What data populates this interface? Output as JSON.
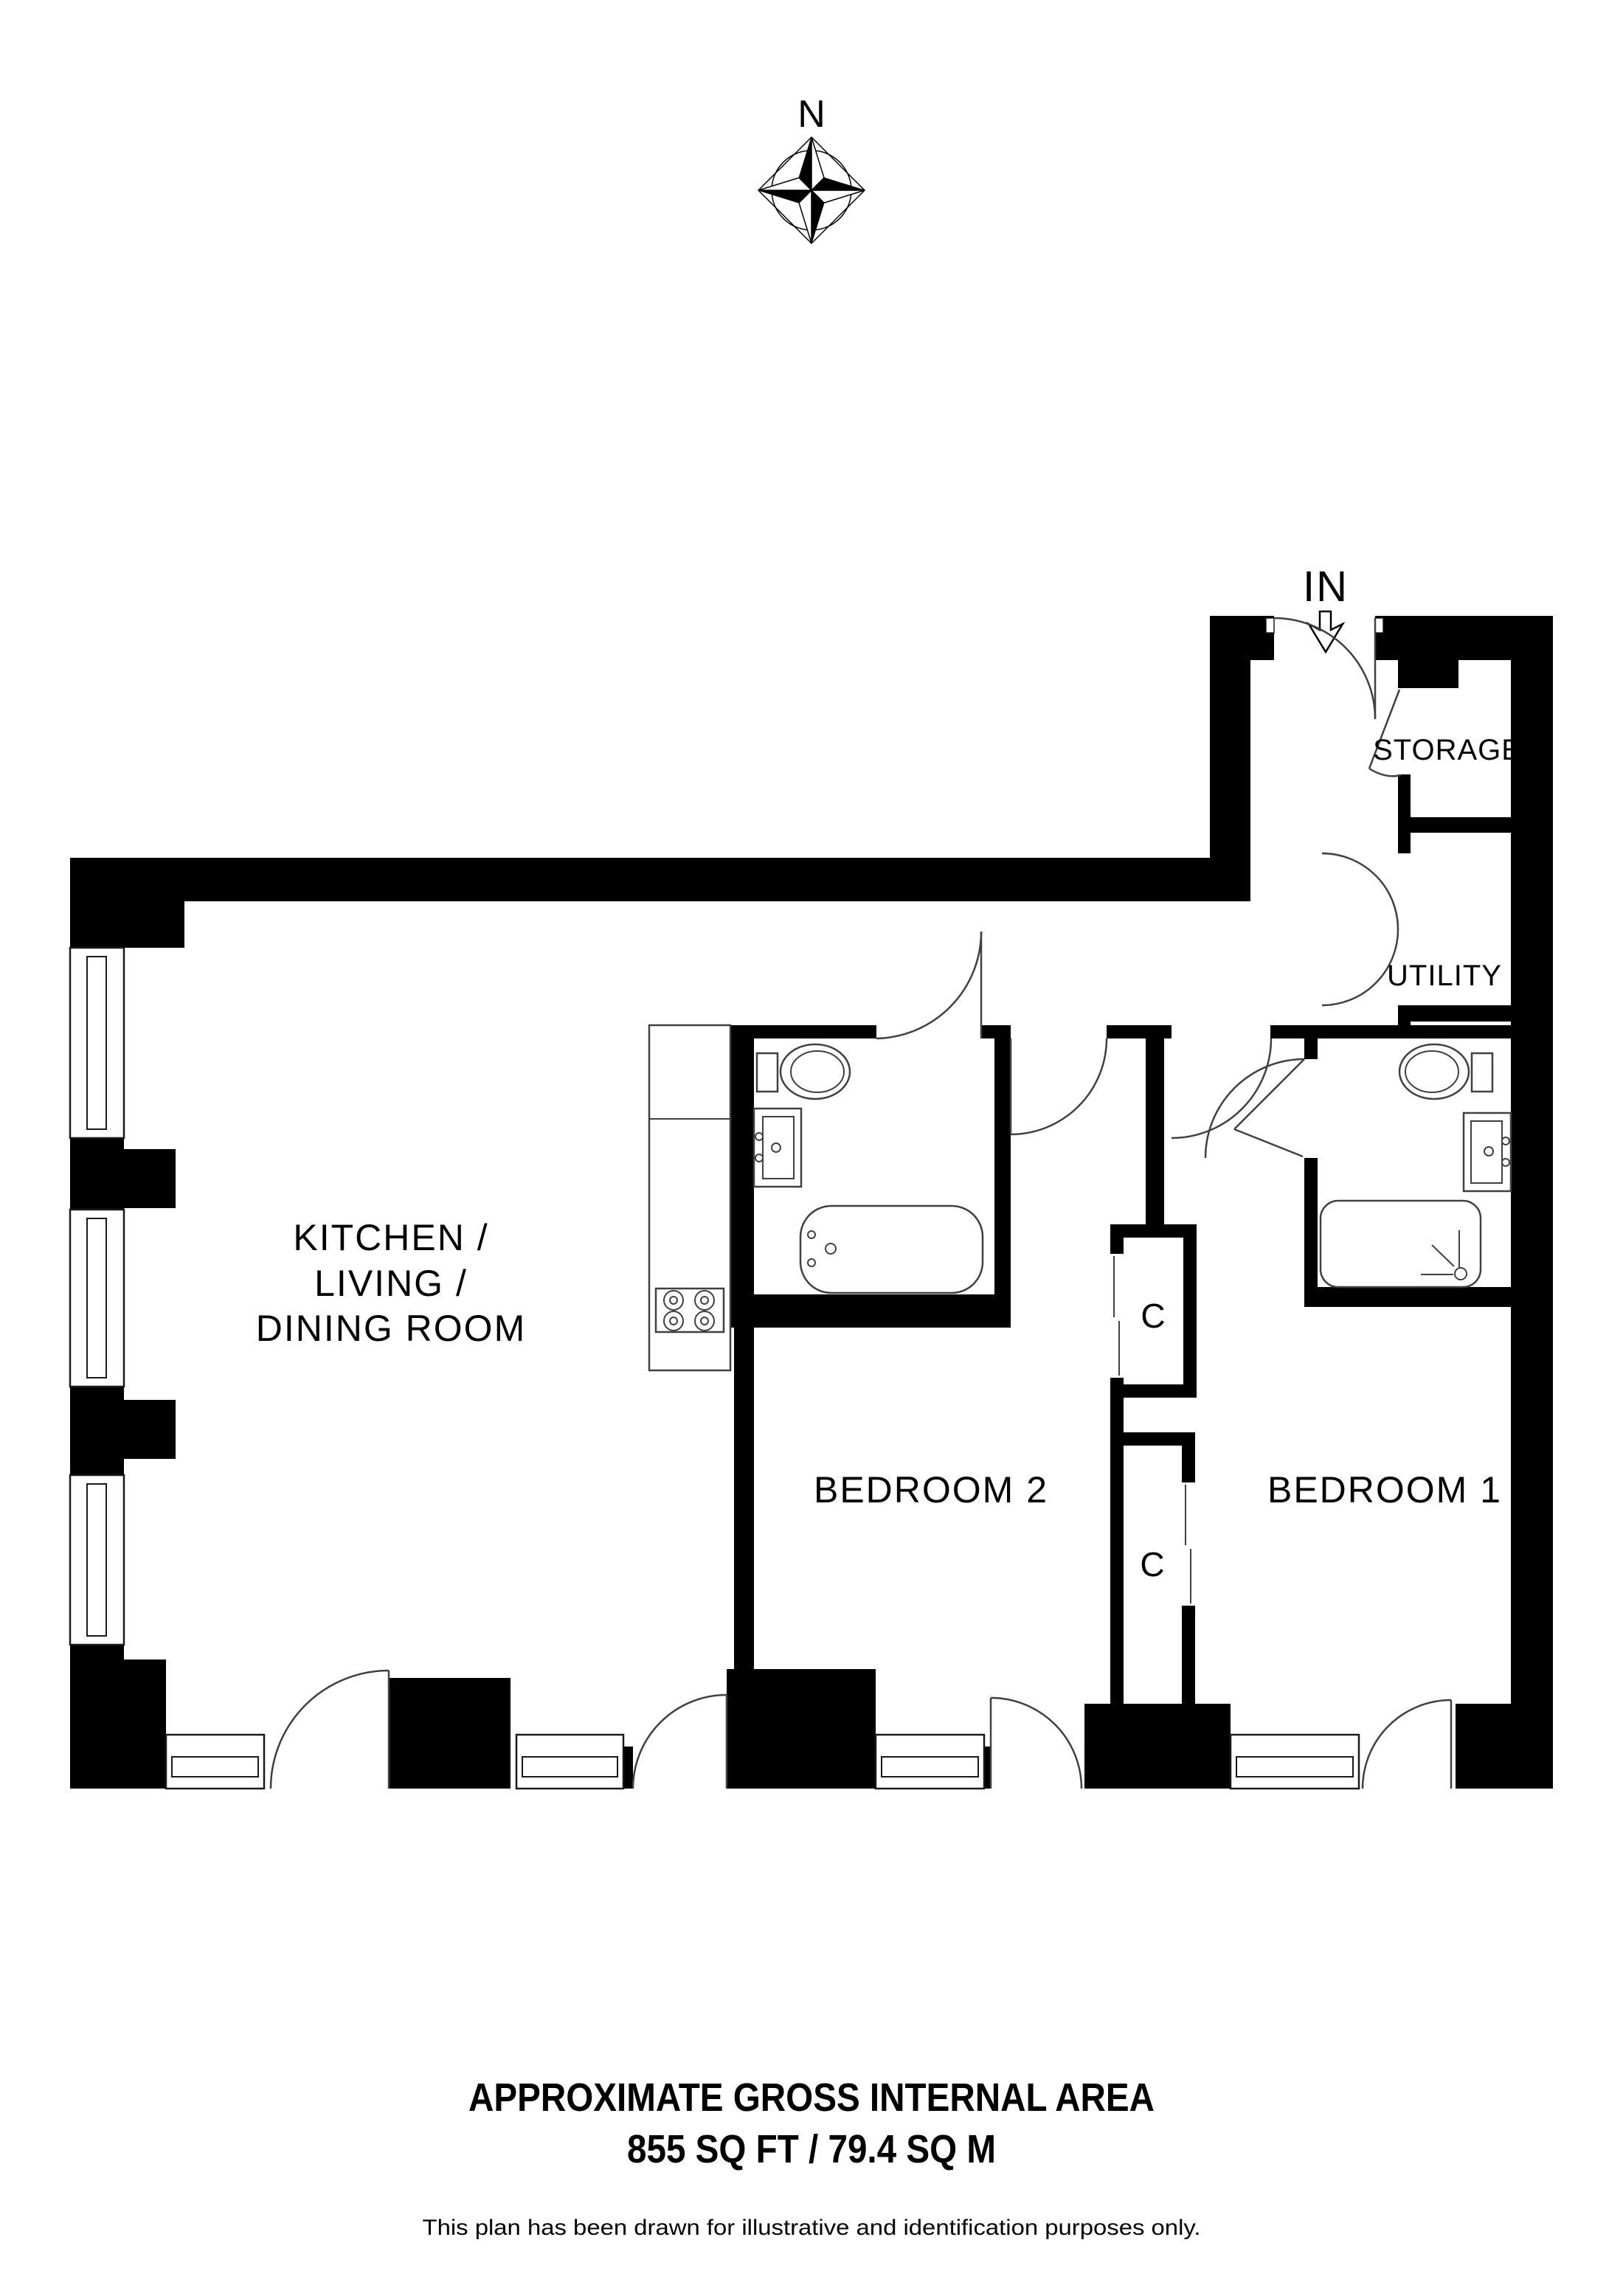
{
  "plan": {
    "compass": {
      "north_label": "N"
    },
    "entrance": {
      "label": "IN"
    },
    "rooms": {
      "kitchen_living_dining": {
        "lines": [
          "KITCHEN /",
          "LIVING /",
          "DINING ROOM"
        ]
      },
      "bedroom_1": {
        "label": "BEDROOM 1"
      },
      "bedroom_2": {
        "label": "BEDROOM 2"
      },
      "storage": {
        "label": "STORAGE"
      },
      "utility": {
        "label": "UTILITY"
      },
      "closet_upper": {
        "label": "C"
      },
      "closet_lower": {
        "label": "C"
      }
    },
    "fixtures": {
      "bathroom": [
        "toilet",
        "sink",
        "bathtub"
      ],
      "ensuite": [
        "toilet",
        "sink",
        "shower"
      ],
      "kitchen": [
        "counter",
        "hob"
      ]
    },
    "footer": {
      "area_title": "APPROXIMATE GROSS INTERNAL AREA",
      "area_value": "855 SQ FT / 79.4 SQ M",
      "disclaimer": "This plan has been drawn for illustrative and identification purposes only."
    },
    "colors": {
      "wall": "#000000",
      "line": "#404040",
      "background": "#ffffff"
    }
  }
}
